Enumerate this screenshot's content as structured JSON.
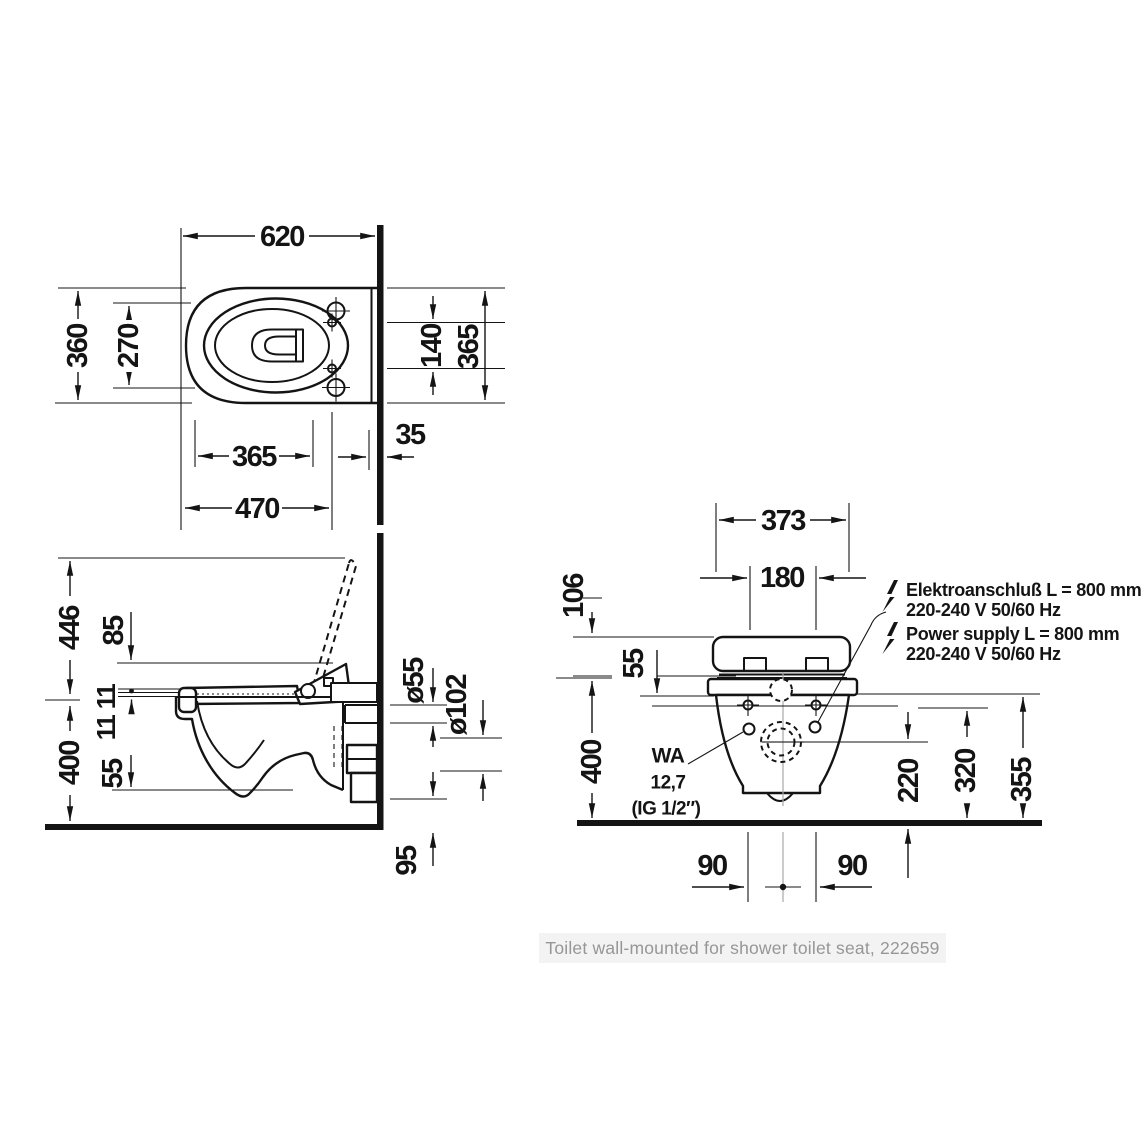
{
  "colors": {
    "line": "#141414",
    "thin_reference": "#a8a8a8",
    "caption_bg": "#f3f3f3",
    "caption_text": "#969696",
    "background": "#ffffff"
  },
  "caption": "Toilet wall-mounted for shower toilet seat, 222659",
  "top_view": {
    "width": "620",
    "depth": "360",
    "bowl_inner": "270",
    "hole_spacing": "140",
    "side_height": "365",
    "wall_offset": "35",
    "hole_distance": "365",
    "drain_distance": "470"
  },
  "side_view": {
    "lid_open_height": "446",
    "unit_height": "85",
    "seat_upper": "11",
    "seat_lower": "11",
    "rim_height": "400",
    "bowl_depth": "55",
    "supply_diameter": "ø55",
    "drain_diameter": "ø102",
    "drain_height": "95"
  },
  "front_view": {
    "width": "373",
    "hole_spacing": "180",
    "top_offset": "106",
    "seat_height": "55",
    "rim_height": "400",
    "drain_center": "220",
    "supply_height": "320",
    "connection_height": "355",
    "left_offset": "90",
    "right_offset": "90",
    "wa_label": "WA",
    "wa_value": "12,7",
    "wa_thread": "(IG 1/2″)",
    "electro_de_line1": "Elektroanschluß L = 800 mm",
    "electro_de_line2": "220-240 V  50/60 Hz",
    "electro_en_line1": "Power supply L = 800 mm",
    "electro_en_line2": "220-240 V  50/60 Hz"
  }
}
